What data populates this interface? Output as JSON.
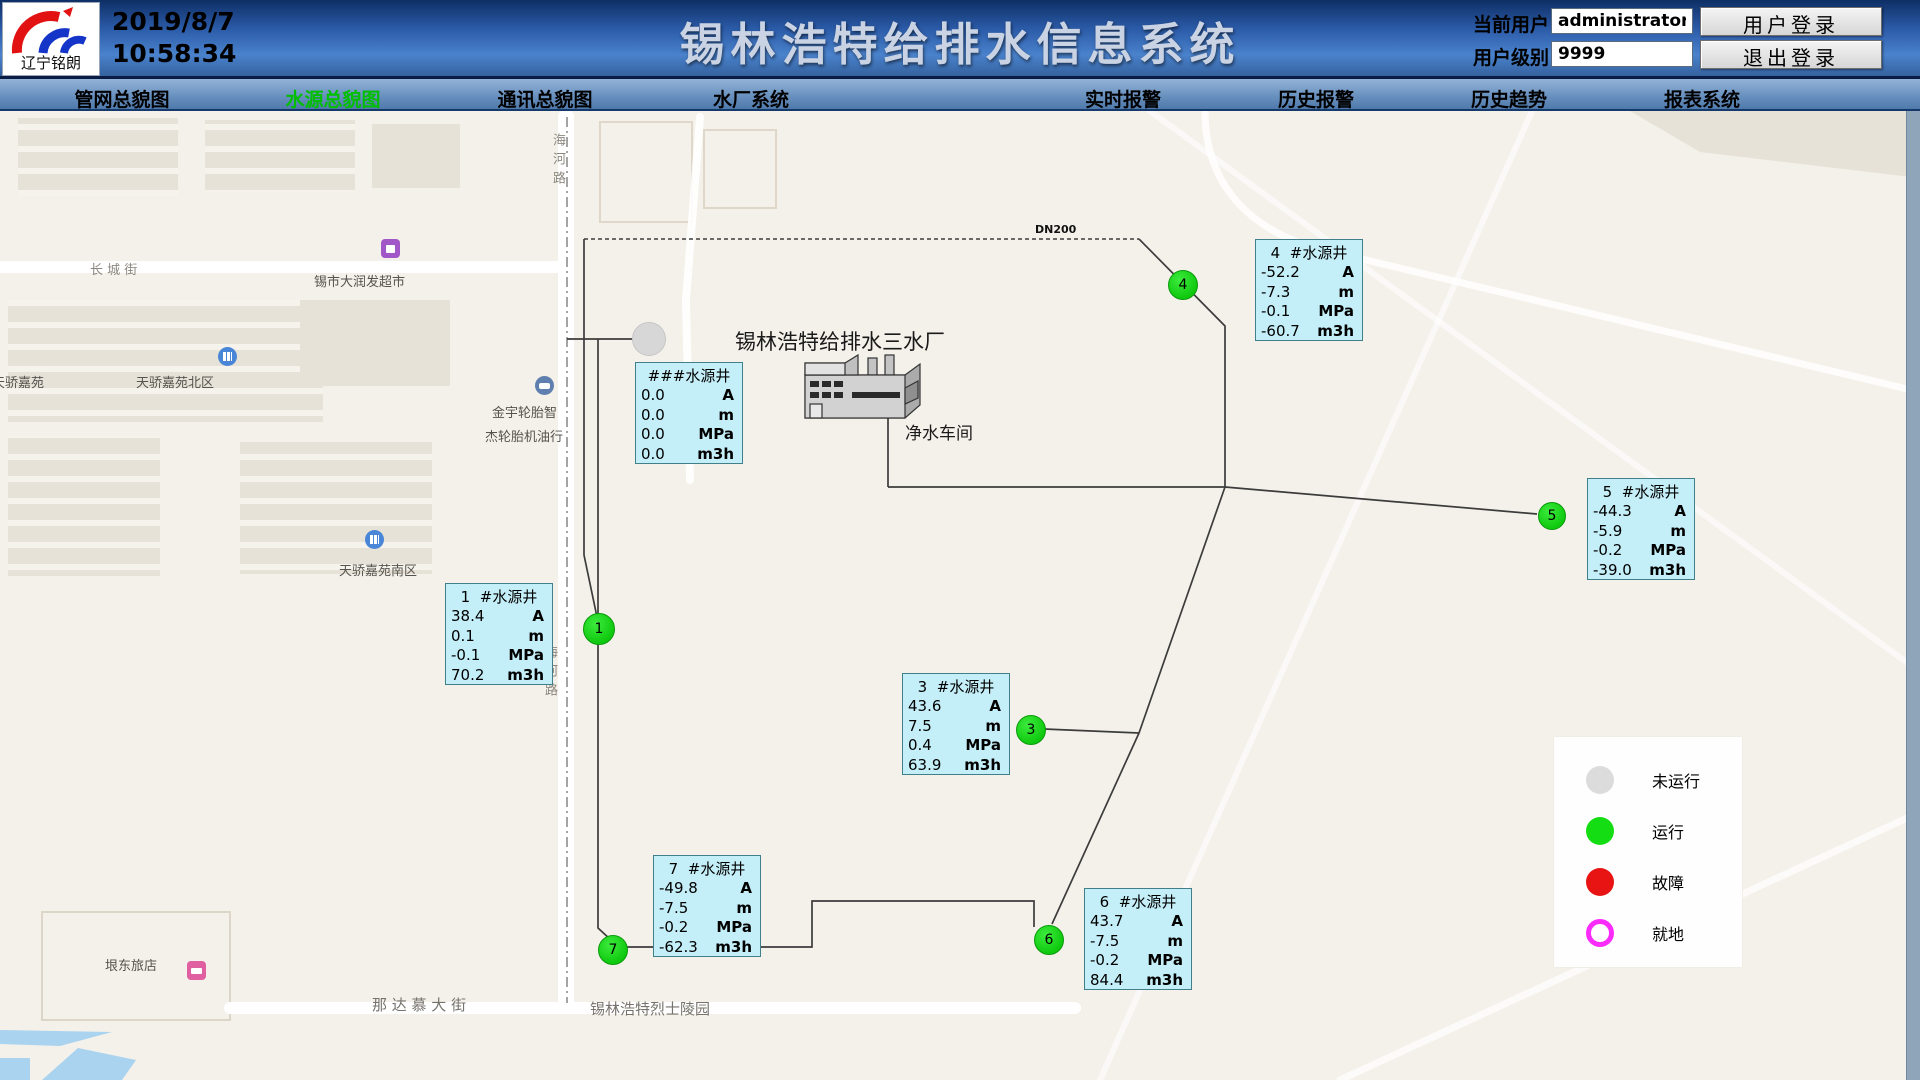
{
  "header": {
    "logo_text": "辽宁铭朗",
    "date": "2019/8/7",
    "time": "10:58:34",
    "title": "锡林浩特给排水信息系统",
    "current_user_label": "当前用户",
    "current_user_value": "administrator",
    "user_level_label": "用户级别",
    "user_level_value": "9999",
    "login_button": "用户登录",
    "logout_button": "退出登录"
  },
  "nav": {
    "items": [
      {
        "label": "管网总貌图",
        "x": 122,
        "active": false
      },
      {
        "label": "水源总貌图",
        "x": 333,
        "active": true
      },
      {
        "label": "通讯总貌图",
        "x": 545,
        "active": false
      },
      {
        "label": "水厂系统",
        "x": 751,
        "active": false
      },
      {
        "label": "实时报警",
        "x": 1123,
        "active": false
      },
      {
        "label": "历史报警",
        "x": 1316,
        "active": false
      },
      {
        "label": "历史趋势",
        "x": 1509,
        "active": false
      },
      {
        "label": "报表系统",
        "x": 1702,
        "active": false
      }
    ]
  },
  "map": {
    "plant_title": "锡林浩特给排水三水厂",
    "workshop_label": "净水车间",
    "pipe_label": "DN200",
    "street_labels": [
      {
        "text": "海河路",
        "x": 548,
        "y": 133,
        "cls": "vertical"
      },
      {
        "text": "长 城 街",
        "x": 90,
        "y": 259,
        "cls": "street"
      },
      {
        "text": "锡市大润发超市",
        "x": 314,
        "y": 271,
        "cls": ""
      },
      {
        "text": "天骄嘉苑",
        "x": -8,
        "y": 372,
        "cls": ""
      },
      {
        "text": "天骄嘉苑北区",
        "x": 136,
        "y": 372,
        "cls": ""
      },
      {
        "text": "金宇轮胎智",
        "x": 492,
        "y": 402,
        "cls": ""
      },
      {
        "text": "杰轮胎机油行",
        "x": 485,
        "y": 426,
        "cls": ""
      },
      {
        "text": "天骄嘉苑南区",
        "x": 339,
        "y": 560,
        "cls": ""
      },
      {
        "text": "海河路",
        "x": 540,
        "y": 645,
        "cls": "vertical"
      },
      {
        "text": "垠东旅店",
        "x": 105,
        "y": 955,
        "cls": ""
      },
      {
        "text": "那 达 慕 大 街",
        "x": 372,
        "y": 994,
        "cls": "street-big"
      },
      {
        "text": "锡林浩特烈士陵园",
        "x": 590,
        "y": 998,
        "cls": "street-big"
      }
    ],
    "pois": [
      {
        "type": "shopping",
        "x": 381,
        "y": 239,
        "color": "#A257C8"
      },
      {
        "type": "residence",
        "x": 218,
        "y": 347,
        "color": "#4A86D8"
      },
      {
        "type": "car",
        "x": 535,
        "y": 376,
        "color": "#5F7FAE"
      },
      {
        "type": "residence",
        "x": 365,
        "y": 530,
        "color": "#4A86D8"
      },
      {
        "type": "hotel",
        "x": 187,
        "y": 961,
        "color": "#E05FA0"
      }
    ]
  },
  "wells": [
    {
      "title": "###水源井",
      "x": 635,
      "y": 362,
      "rows": [
        {
          "value": "0.0",
          "unit": "A"
        },
        {
          "value": "0.0",
          "unit": "m"
        },
        {
          "value": "0.0",
          "unit": "MPa"
        },
        {
          "value": "0.0",
          "unit": "m3h"
        }
      ]
    },
    {
      "title": "1  #水源井",
      "x": 445,
      "y": 583,
      "rows": [
        {
          "value": "38.4",
          "unit": "A"
        },
        {
          "value": "0.1",
          "unit": "m"
        },
        {
          "value": "-0.1",
          "unit": "MPa"
        },
        {
          "value": "70.2",
          "unit": "m3h"
        }
      ]
    },
    {
      "title": "3  #水源井",
      "x": 902,
      "y": 673,
      "rows": [
        {
          "value": "43.6",
          "unit": "A"
        },
        {
          "value": "7.5",
          "unit": "m"
        },
        {
          "value": "0.4",
          "unit": "MPa"
        },
        {
          "value": "63.9",
          "unit": "m3h"
        }
      ]
    },
    {
      "title": "4  #水源井",
      "x": 1255,
      "y": 239,
      "rows": [
        {
          "value": "-52.2",
          "unit": "A"
        },
        {
          "value": "-7.3",
          "unit": "m"
        },
        {
          "value": "-0.1",
          "unit": "MPa"
        },
        {
          "value": "-60.7",
          "unit": "m3h"
        }
      ]
    },
    {
      "title": "5  #水源井",
      "x": 1587,
      "y": 478,
      "rows": [
        {
          "value": "-44.3",
          "unit": "A"
        },
        {
          "value": "-5.9",
          "unit": "m"
        },
        {
          "value": "-0.2",
          "unit": "MPa"
        },
        {
          "value": "-39.0",
          "unit": "m3h"
        }
      ]
    },
    {
      "title": "6  #水源井",
      "x": 1084,
      "y": 888,
      "rows": [
        {
          "value": "43.7",
          "unit": "A"
        },
        {
          "value": "-7.5",
          "unit": "m"
        },
        {
          "value": "-0.2",
          "unit": "MPa"
        },
        {
          "value": "84.4",
          "unit": "m3h"
        }
      ]
    },
    {
      "title": "7  #水源井",
      "x": 653,
      "y": 855,
      "rows": [
        {
          "value": "-49.8",
          "unit": "A"
        },
        {
          "value": "-7.5",
          "unit": "m"
        },
        {
          "value": "-0.2",
          "unit": "MPa"
        },
        {
          "value": "-62.3",
          "unit": "m3h"
        }
      ]
    }
  ],
  "markers": [
    {
      "label": "",
      "state": "idle",
      "x": 648,
      "y": 338,
      "r": 16
    },
    {
      "label": "1",
      "state": "running",
      "x": 598,
      "y": 628,
      "r": 15
    },
    {
      "label": "3",
      "state": "running",
      "x": 1030,
      "y": 729,
      "r": 14
    },
    {
      "label": "4",
      "state": "running",
      "x": 1182,
      "y": 284,
      "r": 14
    },
    {
      "label": "5",
      "state": "running",
      "x": 1551,
      "y": 515,
      "r": 13
    },
    {
      "label": "6",
      "state": "running",
      "x": 1048,
      "y": 939,
      "r": 14
    },
    {
      "label": "7",
      "state": "running",
      "x": 612,
      "y": 949,
      "r": 14
    }
  ],
  "legend": {
    "items": [
      {
        "label": "未运行",
        "color": "#DCDCDC",
        "ring": false
      },
      {
        "label": "运行",
        "color": "#14DD14",
        "ring": false
      },
      {
        "label": "故障",
        "color": "#E81414",
        "ring": false
      },
      {
        "label": "就地",
        "color": "#FB2BFB",
        "ring": true
      }
    ]
  },
  "colors": {
    "nav_active": "#00BE00",
    "well_box_bg": "#C5EFF8",
    "running_green": "#14DD14",
    "idle_gray": "#D7D7D7",
    "fault_red": "#E81414",
    "local_magenta": "#FB2BFB"
  }
}
